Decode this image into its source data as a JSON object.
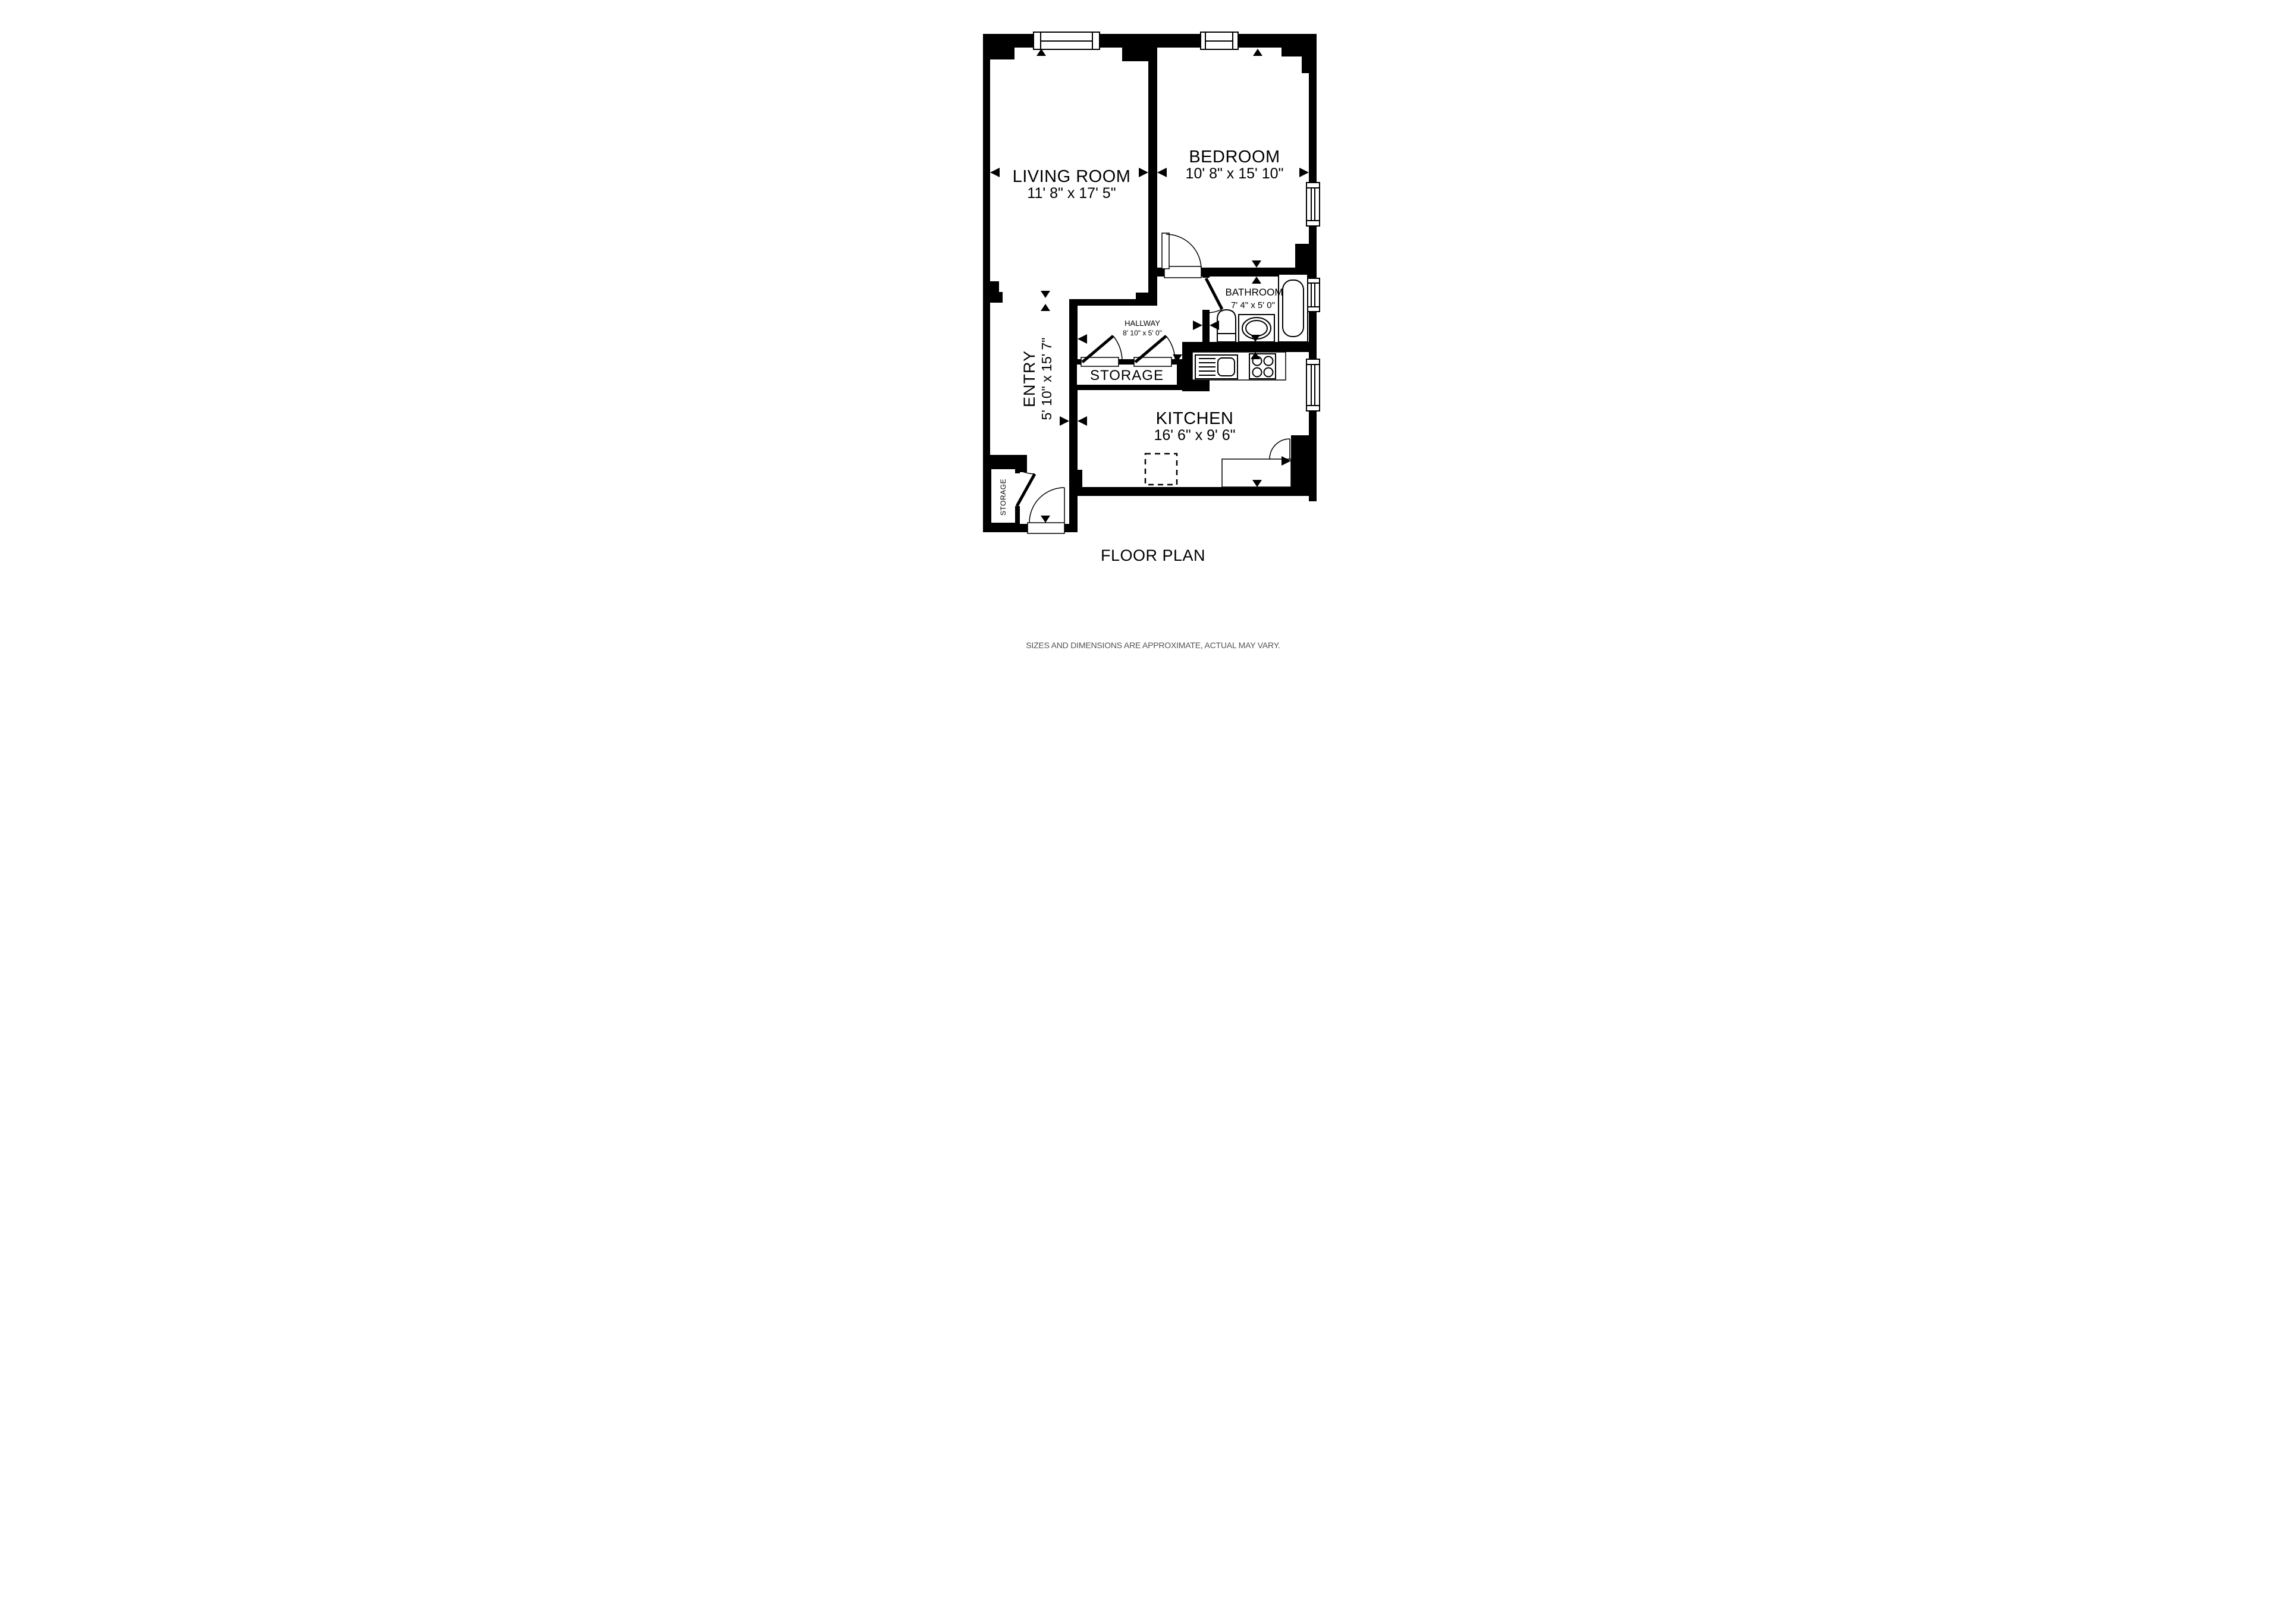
{
  "page": {
    "title": "FLOOR PLAN",
    "footer": "SIZES AND DIMENSIONS ARE APPROXIMATE, ACTUAL MAY VARY."
  },
  "rooms": {
    "living_room": {
      "name": "LIVING ROOM",
      "dims": "11' 8\" x 17' 5\""
    },
    "bedroom": {
      "name": "BEDROOM",
      "dims": "10' 8\" x 15' 10\""
    },
    "bathroom": {
      "name": "BATHROOM",
      "dims": "7' 4\" x 5' 0\""
    },
    "hallway": {
      "name": "HALLWAY",
      "dims": "8' 10\" x 5' 0\""
    },
    "storage_closet": {
      "name": "STORAGE"
    },
    "entry": {
      "name": "ENTRY",
      "dims": "5' 10\" x 15' 7\""
    },
    "kitchen": {
      "name": "KITCHEN",
      "dims": "16' 6\" x 9' 6\""
    },
    "entry_storage": {
      "name": "STORAGE"
    }
  },
  "colors": {
    "walls": "#000000",
    "background": "#ffffff",
    "footer_text": "#545454"
  }
}
